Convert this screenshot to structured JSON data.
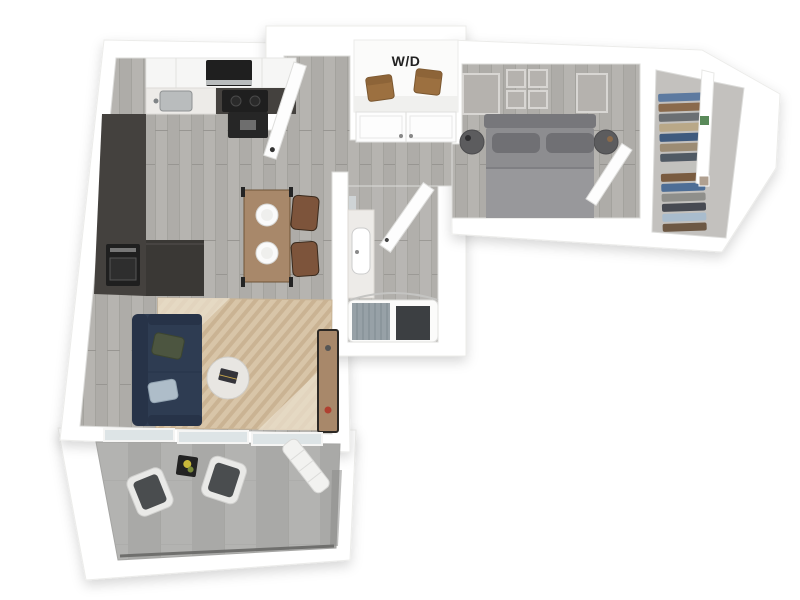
{
  "scene": {
    "laundry_label": "W/D",
    "view": "3D top-down apartment floor plan rendering",
    "rooms": [
      "kitchen",
      "dining",
      "entry-hall",
      "laundry-closet",
      "hall-closet",
      "bathroom",
      "bedroom",
      "walk-in-closet",
      "living-room",
      "balcony"
    ],
    "inventory": {
      "kitchen": [
        "upper-cabinets",
        "microwave",
        "range-hood",
        "cooktop",
        "sink",
        "counter",
        "oven",
        "island"
      ],
      "dining": [
        "wood-table",
        "leather-chairs",
        "plates"
      ],
      "entry": [
        "entry-door",
        "double-door-closet"
      ],
      "laundry": [
        "washer",
        "dryer"
      ],
      "bathroom": [
        "mirror",
        "vanity-sink",
        "bath-door",
        "bathtub",
        "shower-curtain",
        "bath-mat"
      ],
      "bedroom": [
        "wall-art-frames",
        "headboard",
        "bed",
        "pillows",
        "nightstands",
        "bedroom-door"
      ],
      "walk_in_closet": [
        "hanging-clothes",
        "divider-wall",
        "shelf-decor"
      ],
      "living_room": [
        "navy-sofa",
        "throw-pillows",
        "area-rug",
        "round-coffee-table",
        "media-console"
      ],
      "balcony": [
        "patio-chair",
        "patio-chair",
        "side-table",
        "flowers",
        "lounger",
        "railing",
        "glass-wall"
      ]
    }
  },
  "colors": {
    "wall": "#ffffff",
    "floor_wood": "#b6b4b0",
    "floor_wood_streak": "#aeaca8",
    "bath_floor": "#b0aeaa",
    "closet_floor": "#c3c1be",
    "balcony_concrete": "#b3b3b1",
    "balcony_concrete_dark": "#a9a9a7",
    "railing": "#6f6f6d",
    "upper_cabinet": "#f6f6f5",
    "cabinet_dark": "#44413e",
    "island_dark": "#3a3835",
    "appliance_black": "#1f1f1f",
    "hood_black": "#262626",
    "steel": "#b9bcbd",
    "marble": "#edebe8",
    "table_wood": "#a8886a",
    "chair_leather": "#7d543b",
    "plate_white": "#fafafa",
    "sofa_navy": "#2e3c52",
    "sofa_navy_dark": "#273348",
    "pillow_green": "#4c5540",
    "pillow_blue": "#aebdc9",
    "rug_tan": "#d8c5a8",
    "rug_stripe": "#c8b190",
    "rug_light": "#e9dfcc",
    "coffee_table": "#e8e6e2",
    "console_wood": "#a8886a",
    "decor_red": "#b04030",
    "bed_gray": "#8d8d90",
    "bed_blanket": "#98989b",
    "bed_pillow": "#707074",
    "headboard": "#77777b",
    "nightstand": "#5c5c5e",
    "art_gray": "#b5b2ae",
    "door_white": "#fdfdfd",
    "curtain_gray": "#97a1a7",
    "mat_dark": "#3c3f42",
    "tub_white": "#fbfbfa",
    "mirror": "#cfd4d6",
    "glass": "#dde4e6",
    "washer_brown": "#9c7040",
    "chair_cushion": "#4a4d4f",
    "chair_frame": "#e9e9e7",
    "lounger_white": "#f2f2f0",
    "shelf_green": "#5a8a5a"
  },
  "closet": {
    "clothes_colors": [
      "#5d7aa0",
      "#8a6a4c",
      "#6b6f73",
      "#b9a888",
      "#3e5a7e",
      "#9c8c74",
      "#505a64",
      "#c2c2be",
      "#7a5c40",
      "#4e6e96",
      "#8f8f8b",
      "#474a52",
      "#a9bccd",
      "#6d5844"
    ]
  }
}
